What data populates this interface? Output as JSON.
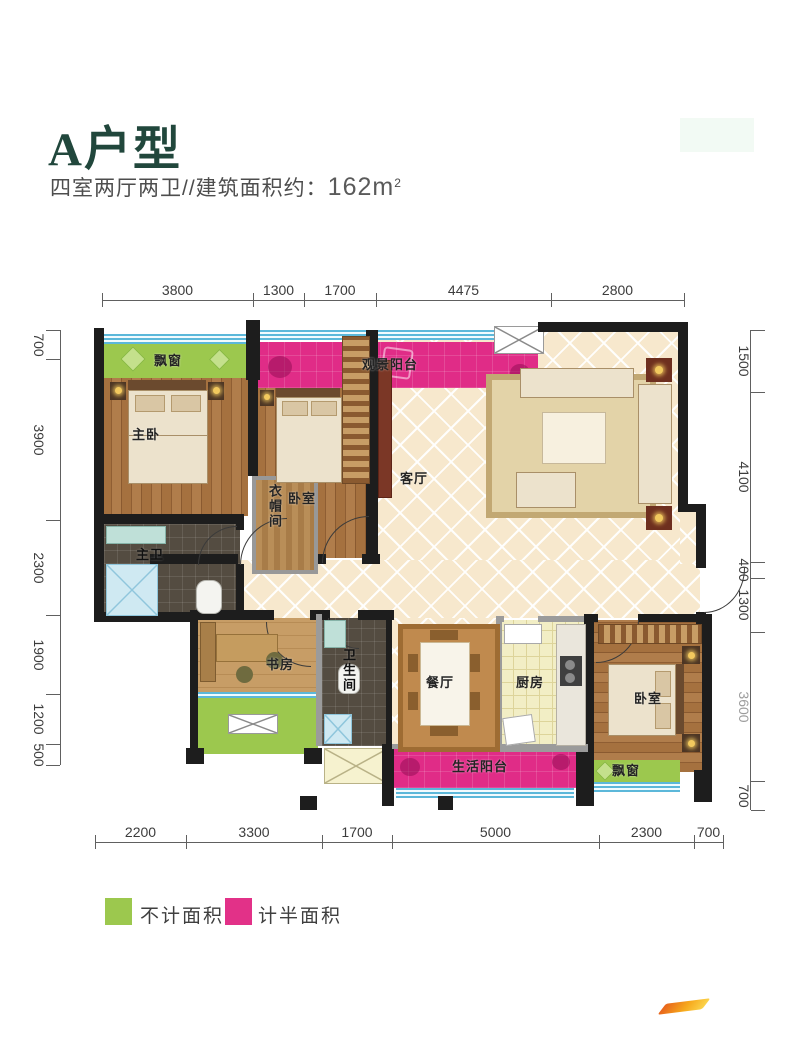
{
  "title": "A户型",
  "subtitle_prefix": "四室两厅两卫//建筑面积约：",
  "area_value": "162m",
  "area_sup": "2",
  "dims": {
    "top": [
      "3800",
      "1300",
      "1700",
      "4475",
      "2800"
    ],
    "bottom": [
      "2200",
      "3300",
      "1700",
      "5000",
      "2300",
      "700"
    ],
    "left": [
      "700",
      "3900",
      "2300",
      "1900",
      "1200",
      "500"
    ],
    "right": [
      "1500",
      "4100",
      "400",
      "1300",
      "3600",
      "700"
    ]
  },
  "rooms": {
    "master_bedroom": "主卧",
    "bedroom2": "卧室",
    "cloakroom": "衣帽间",
    "living": "客厅",
    "master_bath": "主卫",
    "study": "书房",
    "bath2": "卫生间",
    "dining": "餐厅",
    "kitchen": "厨房",
    "bedroom3": "卧室",
    "view_balcony": "观景阳台",
    "life_balcony": "生活阳台",
    "bay_top": "飘窗",
    "bay_bottom": "飘窗"
  },
  "legend": {
    "items": [
      {
        "label": "不计面积",
        "color": "#9cc84e"
      },
      {
        "label": "计半面积",
        "color": "#e23188"
      }
    ]
  },
  "palette": {
    "no_area_green": "#9cc84e",
    "half_area_pink": "#e02c87",
    "window_blue": "#5cb8da",
    "wall_black": "#1d1d1d",
    "tile_floor": "#f7e8cd",
    "wood_floor": "#a5713f",
    "title_green": "#21473c"
  }
}
